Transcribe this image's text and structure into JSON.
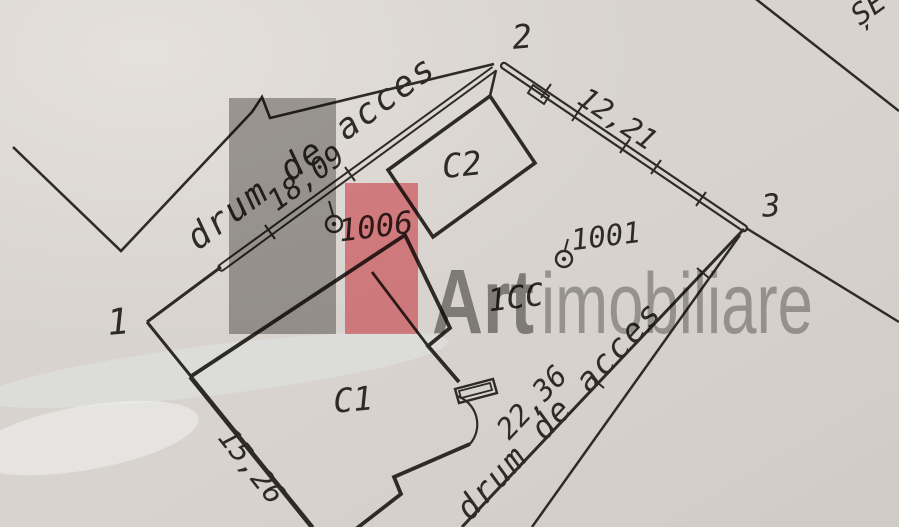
{
  "plan": {
    "corner_labels": {
      "p1": "1",
      "p2": "2",
      "p3": "3"
    },
    "measurements": {
      "side_top": "18,09",
      "side_right": "12,21",
      "side_bottom_right": "22,36",
      "side_bottom_left": "15,26"
    },
    "roads": {
      "top": "drum de acces",
      "bottom": "drum de acces"
    },
    "buildings": {
      "c1": "C1",
      "c2": "C2"
    },
    "land_parcel_label": "1CC",
    "survey_points": {
      "sp1006": "1006",
      "sp1001": "1001"
    },
    "edge_partial_text": "ȘE"
  },
  "watermark": {
    "brand_bold": "Art",
    "brand_light": "imobiliare"
  },
  "colors": {
    "paper": "#d8d3ce",
    "ink": "#2e2b27",
    "watermark_gray": "#a3a19e",
    "watermark_red": "#f0828a",
    "logo_bold": "#83817e",
    "logo_light": "#9f9d9a"
  }
}
